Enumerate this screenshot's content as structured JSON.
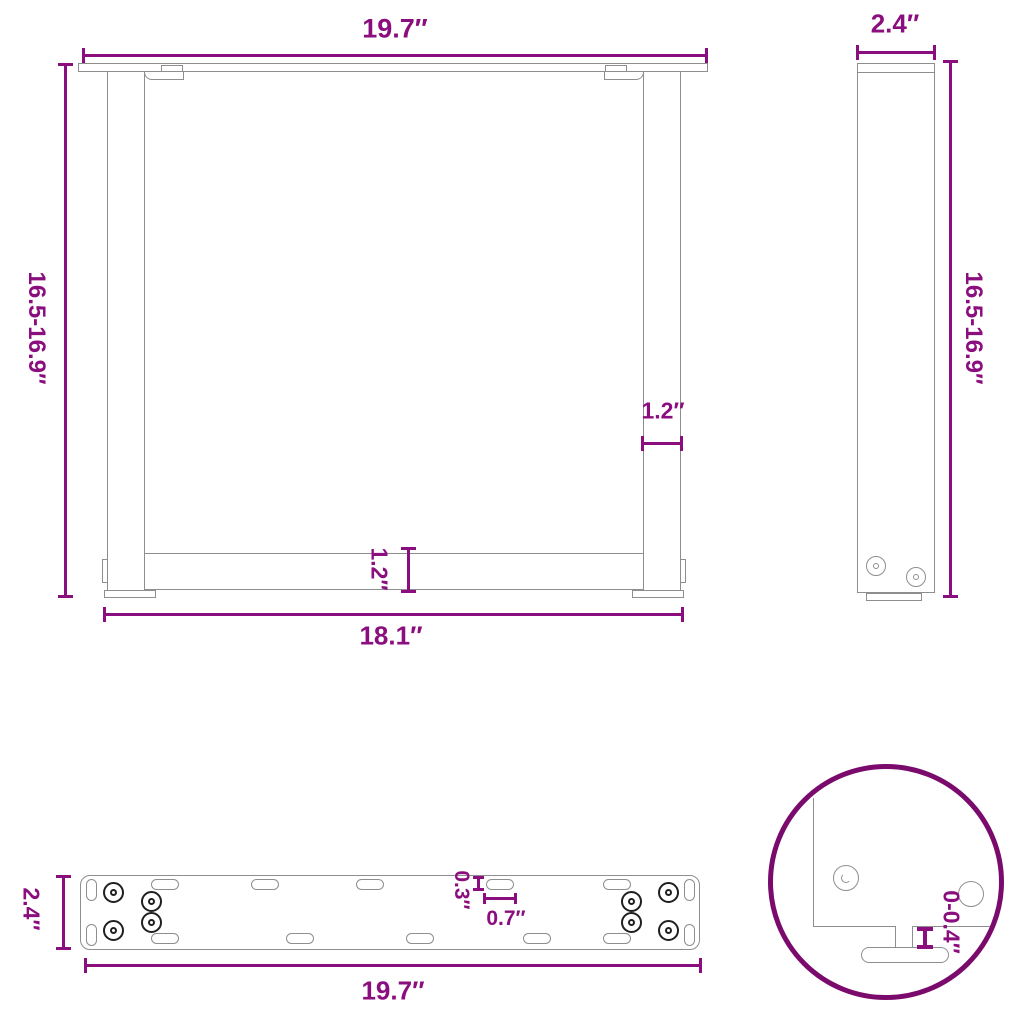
{
  "title": "table-leg-dimension-diagram",
  "units": "inches",
  "colors": {
    "dimension": "#8b0e7e",
    "detail_circle": "#7a0b6d",
    "outline": "#8e8e8e",
    "screw": "#1f1f1f"
  },
  "front_view": {
    "top_width": "19.7″",
    "height_range": "16.5-16.9″",
    "leg_thickness": "1.2″",
    "crossbar_thickness": "1.2″",
    "bottom_width": "18.1″"
  },
  "side_view": {
    "depth": "2.4″",
    "height_range": "16.5-16.9″"
  },
  "plate_view": {
    "depth": "2.4″",
    "length": "19.7″",
    "slot_width": "0.3″",
    "slot_length": "0.7″"
  },
  "detail_view": {
    "foot_adjust_range": "0-0.4″"
  }
}
